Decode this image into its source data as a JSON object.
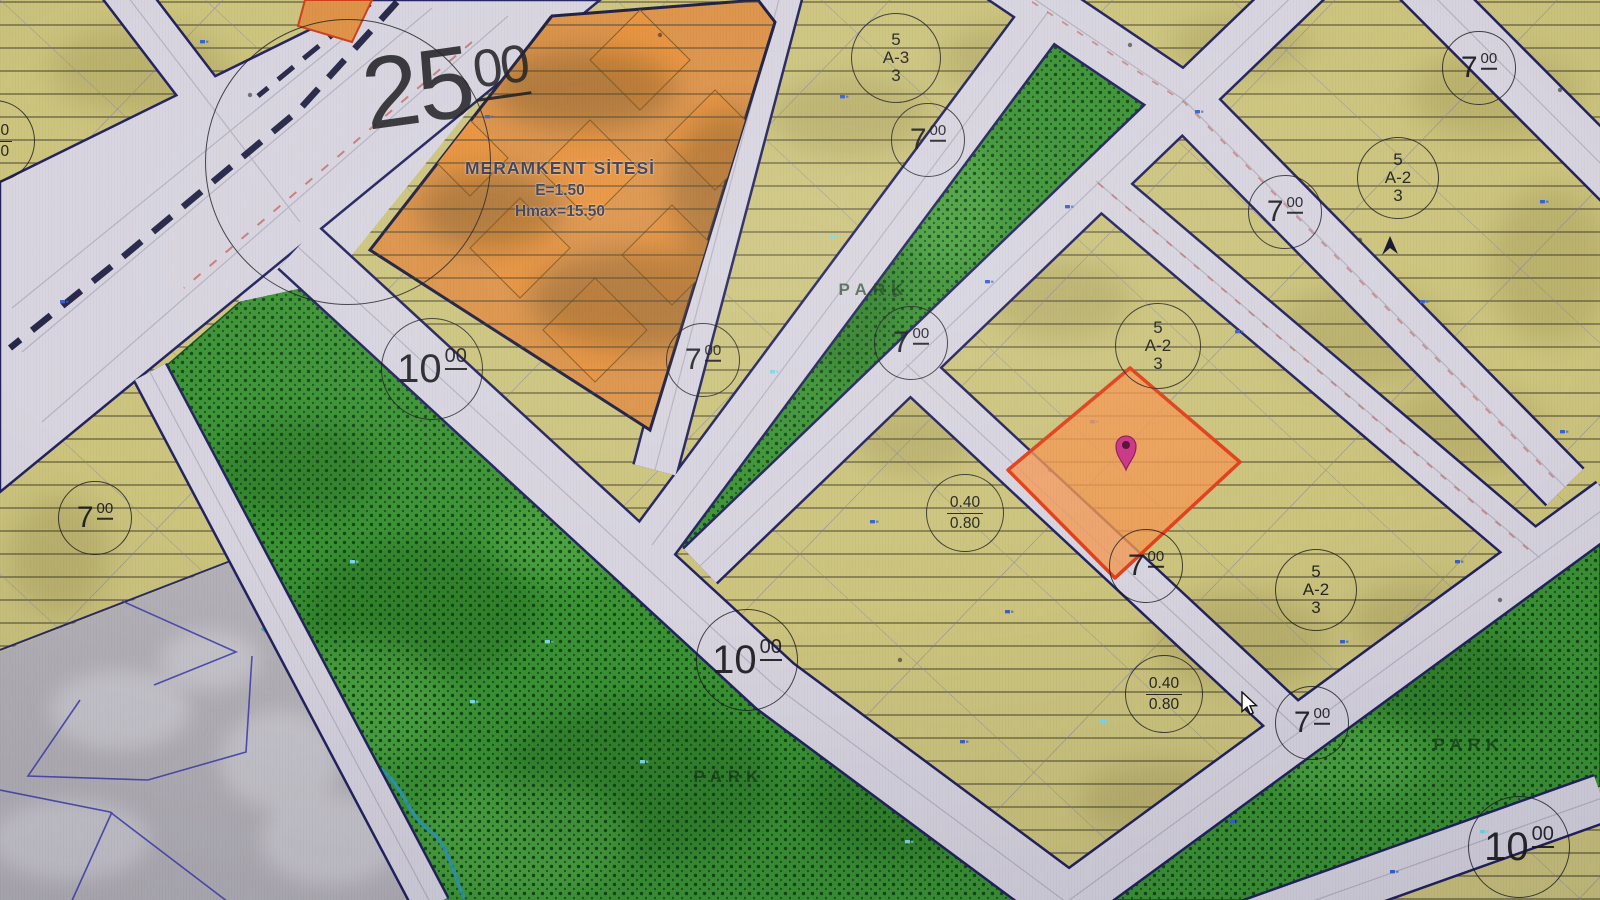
{
  "title": "Zoning plan map (imar planı)",
  "colors": {
    "yellow_zone": "#cdc57e",
    "green_park": "#3c9435",
    "orange_site": "#dd9247",
    "road_fill": "#d8d5e0",
    "road_casing": "#23235f",
    "parcel_highlight": "#f29952",
    "parcel_border": "#e2401a",
    "pin": "#cb3585",
    "creek": "#2e9bc0",
    "gray_zone": "#b5b2b8",
    "label_ink": "#1c1c1c"
  },
  "site_label": {
    "line1": "MERAMKENT SİTESİ",
    "line2": "E=1.50",
    "line3": "Hmax=15.50",
    "x": 560,
    "y": 158
  },
  "width_labels": [
    {
      "value": "25",
      "sup": "00",
      "x": 446,
      "y": 84,
      "rot": -8,
      "variant": "huge",
      "circle": {
        "cx": 348,
        "cy": 162,
        "r": 142
      }
    },
    {
      "value": "10",
      "sup": "00",
      "x": 432,
      "y": 369,
      "r": 50,
      "variant": "large"
    },
    {
      "value": "10",
      "sup": "00",
      "x": 747,
      "y": 660,
      "r": 50,
      "variant": "large"
    },
    {
      "value": "10",
      "sup": "00",
      "x": 1519,
      "y": 847,
      "r": 50,
      "variant": "large"
    },
    {
      "value": "7",
      "sup": "00",
      "x": 95,
      "y": 518,
      "r": 36,
      "variant": "small"
    },
    {
      "value": "7",
      "sup": "00",
      "x": 703,
      "y": 360,
      "r": 36,
      "variant": "small"
    },
    {
      "value": "7",
      "sup": "00",
      "x": 911,
      "y": 343,
      "r": 36,
      "variant": "small"
    },
    {
      "value": "7",
      "sup": "00",
      "x": 928,
      "y": 140,
      "r": 36,
      "variant": "small"
    },
    {
      "value": "7",
      "sup": "00",
      "x": 1285,
      "y": 212,
      "r": 36,
      "variant": "small"
    },
    {
      "value": "7",
      "sup": "00",
      "x": 1479,
      "y": 68,
      "r": 36,
      "variant": "small"
    },
    {
      "value": "7",
      "sup": "00",
      "x": 1146,
      "y": 566,
      "r": 36,
      "variant": "small"
    },
    {
      "value": "7",
      "sup": "00",
      "x": 1312,
      "y": 723,
      "r": 36,
      "variant": "small"
    }
  ],
  "zone_labels": [
    {
      "lines": [
        "5",
        "A-3",
        "3"
      ],
      "x": 896,
      "y": 58,
      "r": 44
    },
    {
      "lines": [
        "5",
        "A-2",
        "3"
      ],
      "x": 1158,
      "y": 346,
      "r": 42
    },
    {
      "lines": [
        "5",
        "A-2",
        "3"
      ],
      "x": 1398,
      "y": 178,
      "r": 40
    },
    {
      "lines": [
        "5",
        "A-2",
        "3"
      ],
      "x": 1316,
      "y": 590,
      "r": 40
    }
  ],
  "ratio_labels": [
    {
      "top": "0.40",
      "bottom": "0.80",
      "x": 965,
      "y": 513,
      "r": 38
    },
    {
      "top": "0.40",
      "bottom": "0.80",
      "x": 1164,
      "y": 694,
      "r": 38
    },
    {
      "top": "0.40",
      "bottom": "0.80",
      "x": -6,
      "y": 141,
      "r": 40
    }
  ],
  "park_labels": [
    {
      "text": "PARK",
      "x": 874,
      "y": 290
    },
    {
      "text": "PARK",
      "x": 729,
      "y": 777
    },
    {
      "text": "PARK",
      "x": 1469,
      "y": 745
    }
  ],
  "selected_parcel": {
    "pin_x": 1126,
    "pin_y": 446
  },
  "cursor": {
    "x": 1242,
    "y": 692
  }
}
